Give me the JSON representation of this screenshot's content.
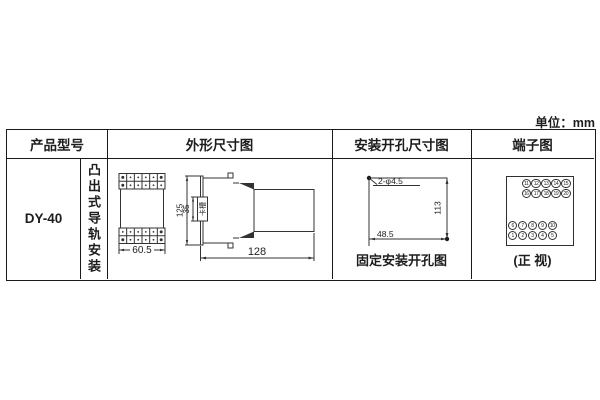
{
  "unit_label": "单位：mm",
  "header": {
    "product_model": "产品型号",
    "outline_dim": "外形尺寸图",
    "mounting_dim": "安装开孔尺寸图",
    "terminal": "端子图"
  },
  "product": {
    "model": "DY-40",
    "mounting_type": "凸出式导轨安装"
  },
  "outline_drawing": {
    "front_width": "60.5",
    "total_height": "125",
    "slot_height": "35",
    "slot_label": "卡槽",
    "depth": "128"
  },
  "mounting_drawing": {
    "holes_label": "2-φ4.5",
    "vertical_pitch": "113",
    "horizontal_pitch": "48.5",
    "caption": "固定安装开孔图"
  },
  "terminal_diagram": {
    "caption": "(正 视)",
    "top_group": [
      [
        "11",
        "12",
        "13",
        "14",
        "15"
      ],
      [
        "16",
        "17",
        "18",
        "19",
        "20"
      ]
    ],
    "bottom_group": [
      [
        "6",
        "7",
        "8",
        "9",
        "10"
      ],
      [
        "1",
        "2",
        "3",
        "4",
        "5"
      ]
    ]
  }
}
